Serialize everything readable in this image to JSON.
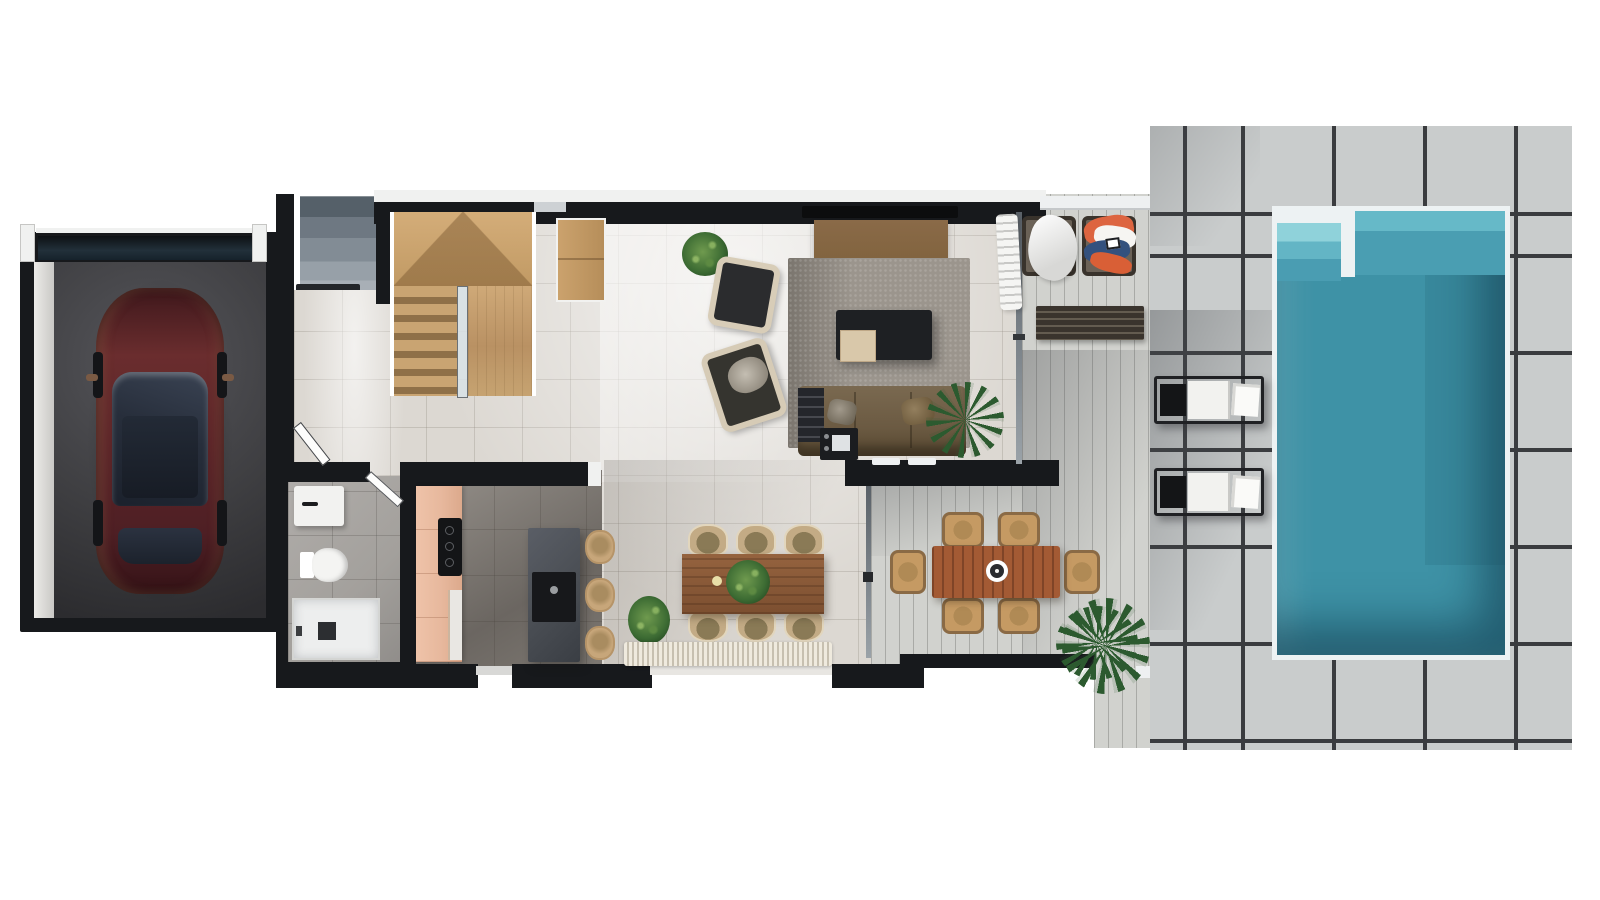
{
  "scene": {
    "type": "3d-floor-plan-render",
    "floor": "ground-floor",
    "description": "Top-down architectural render of a villa ground floor with garage, staircase, open living space, kitchen, bathroom, indoor dining, covered outdoor dining terrace, lounge terrace and a pool deck with swimming pool",
    "rooms": [
      "garage",
      "entry",
      "staircase",
      "living-room",
      "kitchen",
      "bathroom",
      "dining-room",
      "outdoor-dining-terrace",
      "lounge-terrace",
      "pool-deck",
      "swimming-pool"
    ],
    "inventory": {
      "garage": [
        "dark-red-car"
      ],
      "entry": [
        "exterior-steps",
        "front-door",
        "hallway"
      ],
      "staircase": [
        "wood-u-stairs",
        "landing",
        "glass-railing"
      ],
      "living_room": [
        "tv",
        "tv-console",
        "wood-cabinet",
        "potted-plant",
        "armchair",
        "armchair",
        "area-rug",
        "coffee-table",
        "wood-side-cube",
        "sofa-with-cushions",
        "media-shelf",
        "record-player-stand",
        "palm-plant"
      ],
      "kitchen": [
        "peach-cabinet-run",
        "cooktop",
        "oven",
        "stone-island-with-sink",
        "bar-stool",
        "bar-stool",
        "bar-stool"
      ],
      "bathroom": [
        "vanity-sink",
        "toilet",
        "walk-in-shower",
        "door"
      ],
      "dining_room": [
        "wood-dining-table",
        "centerpiece-plant",
        "dining-chair",
        "dining-chair",
        "dining-chair",
        "dining-chair",
        "dining-chair",
        "dining-chair",
        "potted-plant",
        "fringed-runner-rug"
      ],
      "outdoor_dining_terrace": [
        "slatted-wood-table",
        "serving-bowl",
        "wicker-chair",
        "wicker-chair",
        "wicker-chair",
        "wicker-chair",
        "wicker-chair",
        "wicker-chair",
        "palm-plant",
        "glass-wall"
      ],
      "lounge_terrace": [
        "wicker-lounge-chair",
        "wicker-lounge-chair",
        "white-towel",
        "beach-towels",
        "slatted-bench",
        "curtain",
        "pergola-beam"
      ],
      "pool_deck": [
        "sun-lounger",
        "sun-lounger",
        "large-stone-tiles",
        "palm-plant"
      ],
      "swimming_pool": [
        "entry-steps",
        "white-divider-wall",
        "white-rim"
      ]
    },
    "counts": {
      "dining_chairs": 6,
      "outdoor_dining_chairs": 6,
      "bar_stools": 3,
      "sun_loungers": 2,
      "lounge_chairs": 2,
      "armchairs": 2,
      "cars": 1
    }
  },
  "palette": {
    "bg": "#ffffff",
    "wall": "#17191c",
    "white-trim": "#f0f1f0",
    "tile": "#dcd8d2",
    "kitchen-floor-a": "#98938d",
    "kitchen-floor-b": "#6b6661",
    "bath-floor": "#a3a09c",
    "garage-floor": "#3e3e41",
    "garage-lintel": "#22303a",
    "step-gray": "#79838d",
    "stairs-wood": "#c9a472",
    "stairs-dark": "#8f7048",
    "wood-console": "#c2996a",
    "tv-wood": "#82643f",
    "rug": "#9b958d",
    "coffee-table": "#1e2023",
    "cube": "#d9c8aa",
    "sofa": "#6b5a42",
    "plant": "#3c6b33",
    "palm": "#2c5a2f",
    "peach": "#e7b89d",
    "island": "#4b4f55",
    "stool": "#c7a67a",
    "din-table-a": "#95633f",
    "din-table-b": "#7c4f30",
    "out-table": "#a35a34",
    "wicker": "#c59a63",
    "chair-beige": "#c3ab85",
    "plank": "#d1d2ce",
    "deck": "#c9cccc",
    "deck-line": "#3a3c3f",
    "pool": "#3e92a6",
    "pool-light": "#66b9c8",
    "pool-mid": "#4a9eb2",
    "pool-step": "#8fd2da",
    "lounger-frame": "#202124",
    "towel-orange": "#dd6540",
    "towel-blue": "#33517e",
    "car-body": "#5a2428",
    "car-glass": "#272e3b"
  }
}
